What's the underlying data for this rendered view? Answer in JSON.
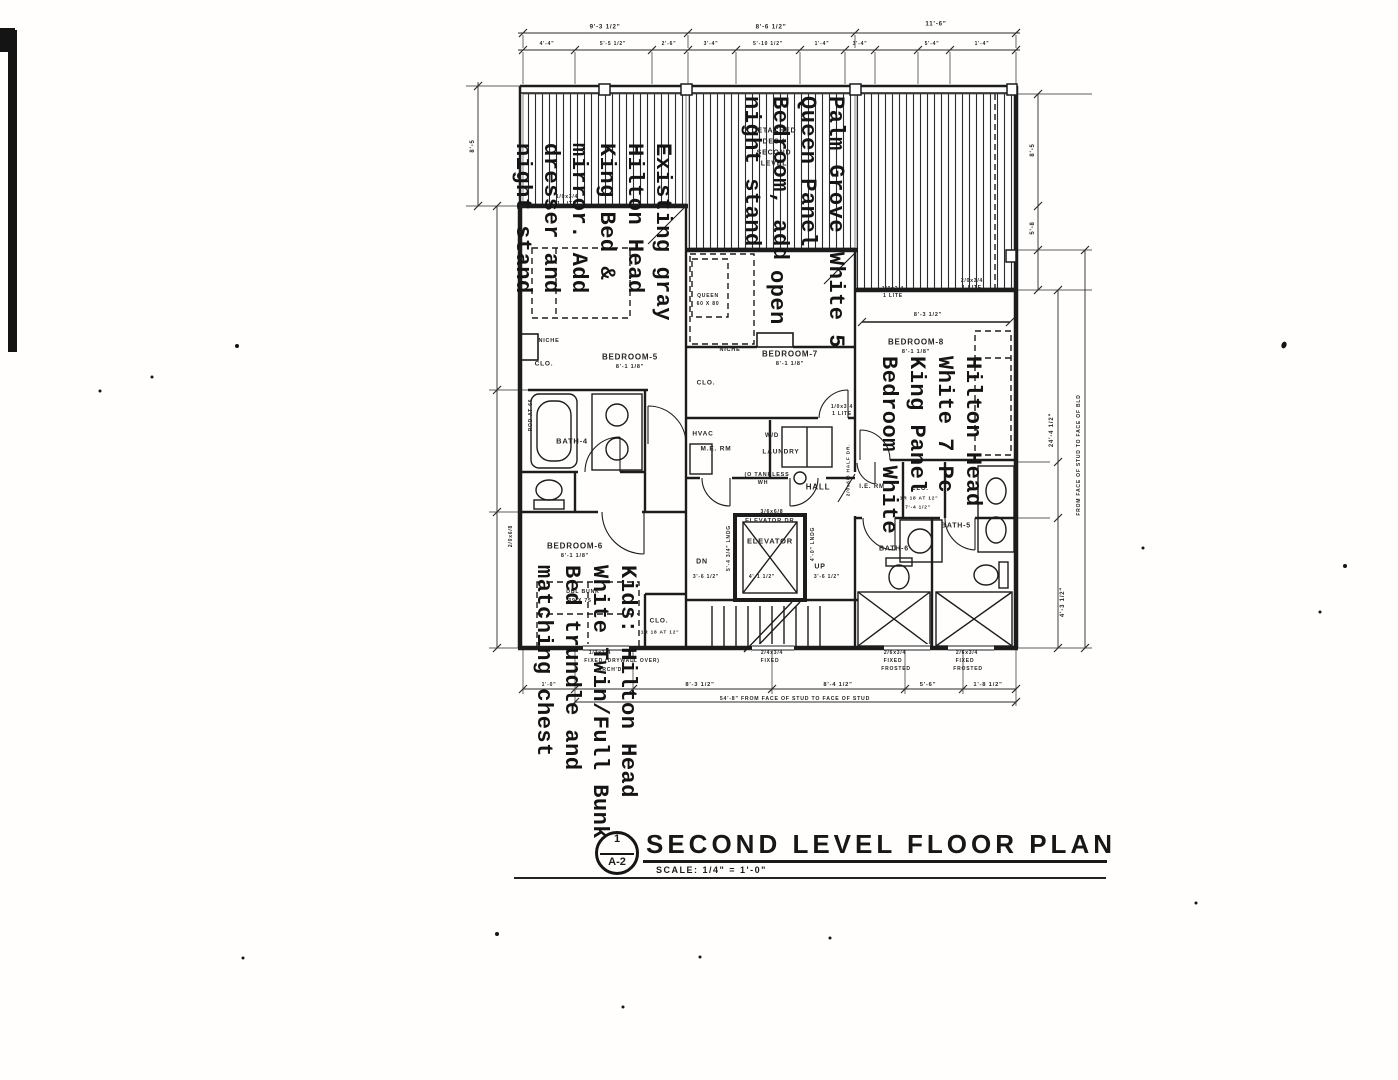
{
  "title_block": {
    "sheet_ref_number": "1",
    "sheet_ref_code": "A-2",
    "title": "SECOND LEVEL FLOOR PLAN",
    "scale": "SCALE: 1/4\" = 1'-0\""
  },
  "annotations": [
    {
      "id": "master-left",
      "top": 143,
      "right": 676,
      "lines": [
        "Existing gray",
        "Hilton Head",
        "King Bed &",
        "mirror. Add",
        "dresser and",
        "night stand"
      ]
    },
    {
      "id": "queen-middle",
      "top": 96,
      "right": 849,
      "lines": [
        "Palm Grove",
        "Queen Panel",
        "Bedroom, add",
        "night stand"
      ]
    },
    {
      "id": "queen-middle-cont",
      "top": 252,
      "right": 849,
      "lines": [
        "White 5"
      ]
    },
    {
      "id": "open-note",
      "top": 270,
      "right": 790,
      "lines": [
        "open"
      ]
    },
    {
      "id": "king-right",
      "top": 356,
      "right": 986,
      "lines": [
        "Hilton Head",
        "White 7 Pc",
        "King Panel",
        "Bedroom White"
      ]
    },
    {
      "id": "kids-bottom",
      "top": 565,
      "right": 641,
      "lines": [
        "Kids: Hilton Head",
        "White Twin/Full Bunk",
        "Bed trundle and",
        "matching chest"
      ]
    }
  ],
  "plan_labels": [
    {
      "t": "BEDROOM-5",
      "x": 630,
      "y": 357,
      "s": 8
    },
    {
      "t": "8'-1 1/8\"",
      "x": 630,
      "y": 367,
      "s": 5.5
    },
    {
      "t": "BEDROOM-7",
      "x": 790,
      "y": 354,
      "s": 8
    },
    {
      "t": "8'-1 1/8\"",
      "x": 790,
      "y": 364,
      "s": 5.5
    },
    {
      "t": "BEDROOM-8",
      "x": 916,
      "y": 342,
      "s": 8
    },
    {
      "t": "8'-1 1/8\"",
      "x": 916,
      "y": 352,
      "s": 5.5
    },
    {
      "t": "BEDROOM-6",
      "x": 575,
      "y": 546,
      "s": 8
    },
    {
      "t": "8'-1 1/8\"",
      "x": 575,
      "y": 556,
      "s": 5.5
    },
    {
      "t": "BATH-4",
      "x": 572,
      "y": 441,
      "s": 7.5
    },
    {
      "t": "BATH-5",
      "x": 956,
      "y": 526,
      "s": 7
    },
    {
      "t": "BATH-6",
      "x": 894,
      "y": 549,
      "s": 7
    },
    {
      "t": "HALL",
      "x": 818,
      "y": 487,
      "s": 8
    },
    {
      "t": "ELEVATOR",
      "x": 770,
      "y": 541,
      "s": 7.5
    },
    {
      "t": "ELEVATOR DR.",
      "x": 771,
      "y": 521,
      "s": 5.8
    },
    {
      "t": "3/6x6/8",
      "x": 772,
      "y": 512,
      "s": 5.2
    },
    {
      "t": "HVAC",
      "x": 703,
      "y": 434,
      "s": 6.5
    },
    {
      "t": "M.E. RM",
      "x": 716,
      "y": 449,
      "s": 6.5
    },
    {
      "t": "W/D",
      "x": 772,
      "y": 436,
      "s": 6
    },
    {
      "t": "LAUNDRY",
      "x": 781,
      "y": 452,
      "s": 6.5
    },
    {
      "t": "(O TANKLESS",
      "x": 767,
      "y": 475,
      "s": 5.4
    },
    {
      "t": "WH",
      "x": 763,
      "y": 483,
      "s": 5.4
    },
    {
      "t": "I.E. RM",
      "x": 872,
      "y": 487,
      "s": 6
    },
    {
      "t": "CLO.",
      "x": 920,
      "y": 489,
      "s": 6
    },
    {
      "t": "1R 18 AT 12\"",
      "x": 919,
      "y": 499,
      "s": 4.8
    },
    {
      "t": "7'-4 1/2\"",
      "x": 918,
      "y": 508,
      "s": 4.8
    },
    {
      "t": "CLO.",
      "x": 544,
      "y": 364,
      "s": 6.5
    },
    {
      "t": "NICHE",
      "x": 549,
      "y": 341,
      "s": 5.5
    },
    {
      "t": "CLO.",
      "x": 706,
      "y": 383,
      "s": 6.5
    },
    {
      "t": "NICHE",
      "x": 730,
      "y": 350,
      "s": 5.5
    },
    {
      "t": "CLO.",
      "x": 659,
      "y": 621,
      "s": 6.5
    },
    {
      "t": "1R 18 AT 12\"",
      "x": 660,
      "y": 633,
      "s": 4.8
    },
    {
      "t": "DETACHED",
      "x": 774,
      "y": 131,
      "s": 7
    },
    {
      "t": "DECK",
      "x": 774,
      "y": 142,
      "s": 7
    },
    {
      "t": "SECOND",
      "x": 774,
      "y": 153,
      "s": 7
    },
    {
      "t": "LEVEL",
      "x": 774,
      "y": 164,
      "s": 7
    },
    {
      "t": "DN",
      "x": 702,
      "y": 562,
      "s": 7
    },
    {
      "t": "UP",
      "x": 820,
      "y": 567,
      "s": 7
    },
    {
      "t": "QUEEN",
      "x": 708,
      "y": 296,
      "s": 5
    },
    {
      "t": "60 X 80",
      "x": 708,
      "y": 304,
      "s": 5
    },
    {
      "t": "DBL BUNK",
      "x": 583,
      "y": 592,
      "s": 5.2
    },
    {
      "t": "39 X 75",
      "x": 580,
      "y": 601,
      "s": 5.2
    },
    {
      "t": "ROD AT 66",
      "x": 531,
      "y": 415,
      "s": 5,
      "r": -90
    },
    {
      "t": "1/0x3/4",
      "x": 567,
      "y": 197,
      "s": 5
    },
    {
      "t": "1 LITE",
      "x": 567,
      "y": 204,
      "s": 5
    },
    {
      "t": "1/0x3/4",
      "x": 893,
      "y": 289,
      "s": 5
    },
    {
      "t": "1 LITE",
      "x": 893,
      "y": 296,
      "s": 5
    },
    {
      "t": "2/0x3/4",
      "x": 972,
      "y": 281,
      "s": 5
    },
    {
      "t": "1 LITE",
      "x": 972,
      "y": 288,
      "s": 5
    },
    {
      "t": "1/0x3/4",
      "x": 842,
      "y": 407,
      "s": 5
    },
    {
      "t": "1 LITE",
      "x": 842,
      "y": 414,
      "s": 5
    },
    {
      "t": "2/0x6/8",
      "x": 511,
      "y": 536,
      "s": 5,
      "r": -90
    },
    {
      "t": "2/0x6/8 HALF DR.",
      "x": 849,
      "y": 470,
      "s": 4.8,
      "r": -90
    },
    {
      "t": "5'-4 3/4\" LNDG",
      "x": 729,
      "y": 548,
      "s": 5,
      "r": -90
    },
    {
      "t": "4'-0\" LNDG",
      "x": 813,
      "y": 544,
      "s": 5,
      "r": -90
    },
    {
      "t": "4'-1 1/2\"",
      "x": 762,
      "y": 577,
      "s": 5
    },
    {
      "t": "3'-6 1/2\"",
      "x": 706,
      "y": 577,
      "s": 5
    },
    {
      "t": "3'-6 1/2\"",
      "x": 827,
      "y": 577,
      "s": 5
    },
    {
      "t": "8'-3 1/2\"",
      "x": 928,
      "y": 315,
      "s": 5.5
    },
    {
      "t": "9'-3 1/2\"",
      "x": 605,
      "y": 27,
      "s": 6.2
    },
    {
      "t": "8'-6 1/2\"",
      "x": 771,
      "y": 27,
      "s": 6.2
    },
    {
      "t": "11'-6\"",
      "x": 936,
      "y": 24,
      "s": 6.2
    },
    {
      "t": "4'-4\"",
      "x": 547,
      "y": 44,
      "s": 5
    },
    {
      "t": "5'-5 1/2\"",
      "x": 613,
      "y": 44,
      "s": 5
    },
    {
      "t": "2'-6\"",
      "x": 669,
      "y": 44,
      "s": 5
    },
    {
      "t": "3'-4\"",
      "x": 711,
      "y": 44,
      "s": 5
    },
    {
      "t": "5'-10 1/2\"",
      "x": 768,
      "y": 44,
      "s": 5
    },
    {
      "t": "1'-4\"",
      "x": 822,
      "y": 44,
      "s": 5
    },
    {
      "t": "3'-4\"",
      "x": 860,
      "y": 44,
      "s": 5
    },
    {
      "t": "5'-4\"",
      "x": 932,
      "y": 44,
      "s": 5
    },
    {
      "t": "1'-4\"",
      "x": 982,
      "y": 44,
      "s": 5
    },
    {
      "t": "8'-5",
      "x": 473,
      "y": 146,
      "s": 6,
      "r": -90
    },
    {
      "t": "8'-5",
      "x": 1033,
      "y": 150,
      "s": 6,
      "r": -90
    },
    {
      "t": "5'-8",
      "x": 1033,
      "y": 228,
      "s": 6,
      "r": -90
    },
    {
      "t": "24'-4 1/2\"",
      "x": 1052,
      "y": 430,
      "s": 6,
      "r": -90
    },
    {
      "t": "4'-3 1/2\"",
      "x": 1063,
      "y": 602,
      "s": 6,
      "r": -90
    },
    {
      "t": "FROM FACE OF STUD TO FACE OF BLD",
      "x": 1079,
      "y": 455,
      "s": 5,
      "r": -90
    },
    {
      "t": "1'-0\"",
      "x": 549,
      "y": 685,
      "s": 5
    },
    {
      "t": "8'-3 1/2\"",
      "x": 700,
      "y": 685,
      "s": 5.8
    },
    {
      "t": "8'-4 1/2\"",
      "x": 838,
      "y": 685,
      "s": 5.8
    },
    {
      "t": "5'-6\"",
      "x": 928,
      "y": 685,
      "s": 5.8
    },
    {
      "t": "1'-8 1/2\"",
      "x": 988,
      "y": 685,
      "s": 5.8
    },
    {
      "t": "54'-8\" FROM FACE OF STUD TO FACE OF STUD",
      "x": 795,
      "y": 699,
      "s": 5.2
    },
    {
      "t": "1/3x3/4",
      "x": 600,
      "y": 653,
      "s": 5
    },
    {
      "t": "FIXED (DRYWALL OVER)",
      "x": 622,
      "y": 661,
      "s": 5
    },
    {
      "t": "ARCH'D",
      "x": 610,
      "y": 670,
      "s": 5
    },
    {
      "t": "2/4x3/4",
      "x": 772,
      "y": 653,
      "s": 5
    },
    {
      "t": "FIXED",
      "x": 770,
      "y": 661,
      "s": 5
    },
    {
      "t": "2/6x3/4",
      "x": 895,
      "y": 653,
      "s": 5
    },
    {
      "t": "FIXED",
      "x": 893,
      "y": 661,
      "s": 5
    },
    {
      "t": "FROSTED",
      "x": 896,
      "y": 669,
      "s": 5
    },
    {
      "t": "2/6x3/4",
      "x": 967,
      "y": 653,
      "s": 5
    },
    {
      "t": "FIXED",
      "x": 965,
      "y": 661,
      "s": 5
    },
    {
      "t": "FROSTED",
      "x": 968,
      "y": 669,
      "s": 5
    }
  ]
}
